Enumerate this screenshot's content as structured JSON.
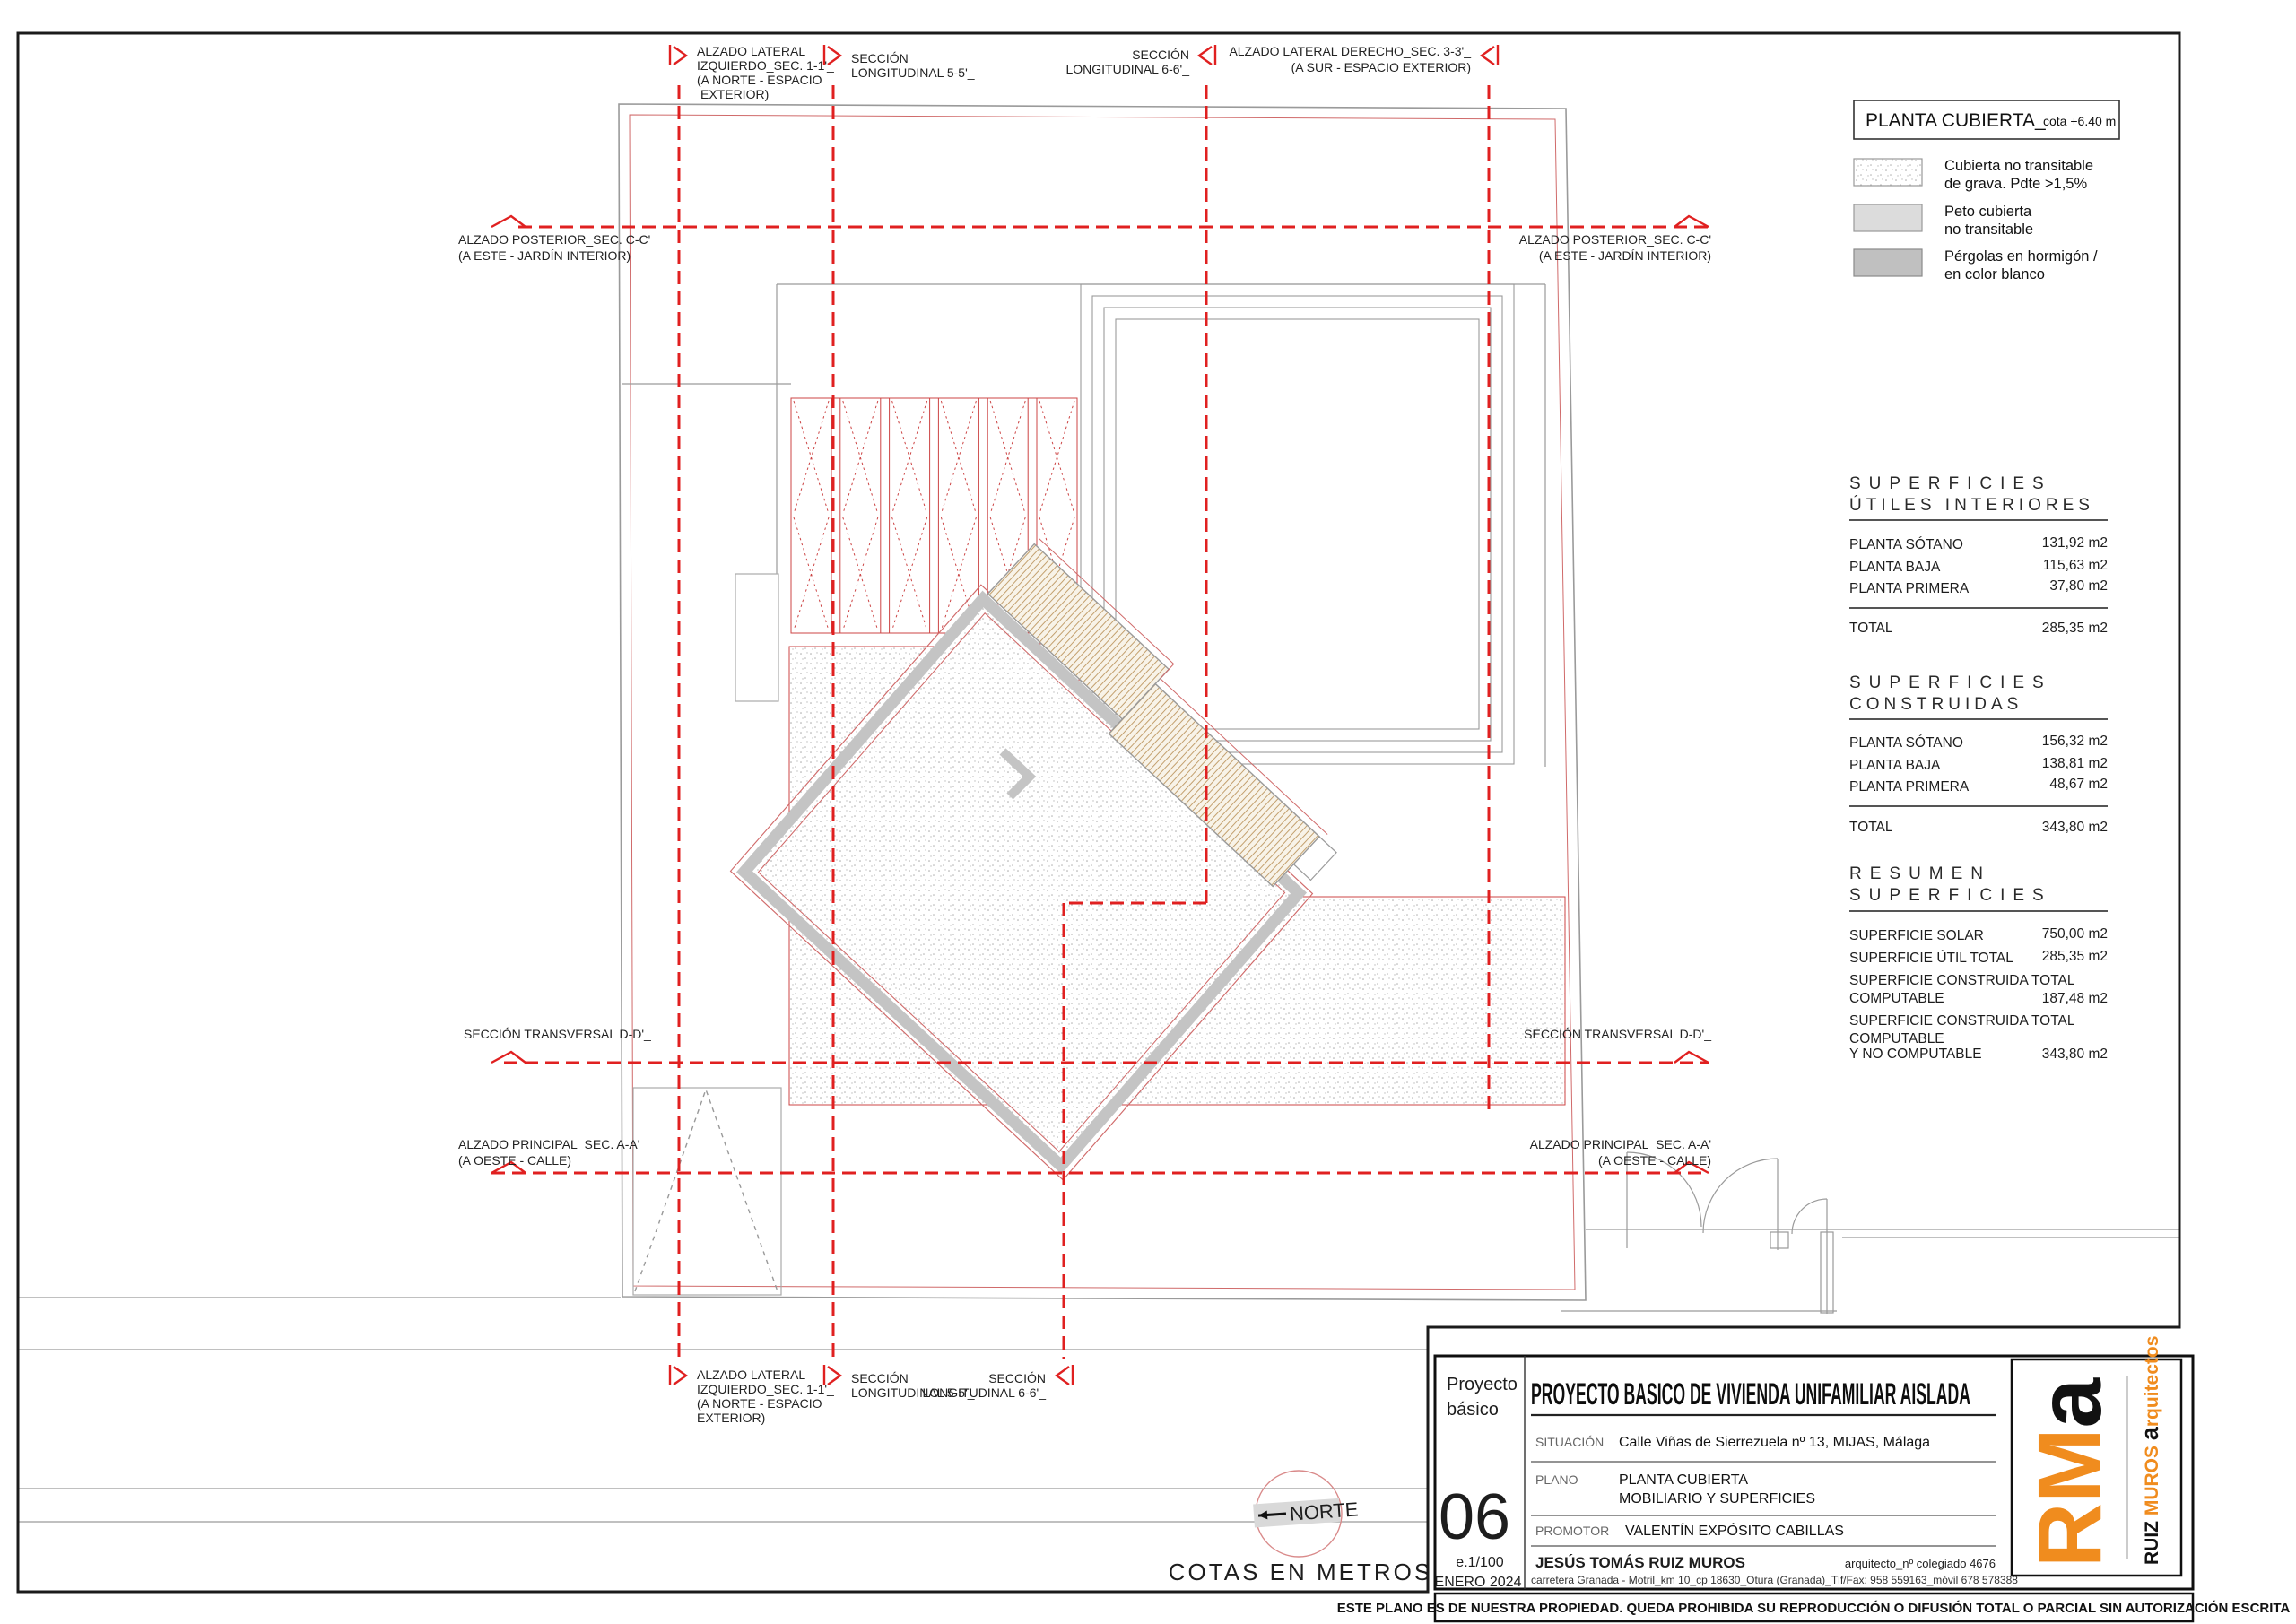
{
  "colors": {
    "section_red": "#e02020",
    "thin_red": "#cc4444",
    "wall_gray": "#c4c4c4",
    "structure_gray": "#9a9a9a",
    "brand_orange": "#f08c1e"
  },
  "legend": {
    "title": "PLANTA CUBIERTA_",
    "subtitle": "cota +6.40 m",
    "items": [
      {
        "lines": [
          "Cubierta no transitable",
          "de grava. Pdte >1,5%"
        ]
      },
      {
        "lines": [
          "Peto cubierta",
          "no transitable"
        ]
      },
      {
        "lines": [
          "Pérgolas en hormigón /",
          "en color blanco"
        ]
      }
    ]
  },
  "tables": {
    "utiles": {
      "title_line1": "SUPERFICIES",
      "title_line2": "ÚTILES INTERIORES",
      "rows": [
        {
          "label": "PLANTA SÓTANO",
          "value": "131,92 m2"
        },
        {
          "label": "PLANTA BAJA",
          "value": "115,63 m2"
        },
        {
          "label": "PLANTA PRIMERA",
          "value": "37,80 m2"
        }
      ],
      "total_label": "TOTAL",
      "total_value": "285,35 m2"
    },
    "construidas": {
      "title_line1": "SUPERFICIES",
      "title_line2": "CONSTRUIDAS",
      "rows": [
        {
          "label": "PLANTA SÓTANO",
          "value": "156,32 m2"
        },
        {
          "label": "PLANTA BAJA",
          "value": "138,81 m2"
        },
        {
          "label": "PLANTA PRIMERA",
          "value": "48,67 m2"
        }
      ],
      "total_label": "TOTAL",
      "total_value": "343,80 m2"
    },
    "resumen": {
      "title_line1": "RESUMEN",
      "title_line2": "SUPERFICIES",
      "rows": [
        {
          "lines": [
            "SUPERFICIE SOLAR"
          ],
          "value": "750,00 m2"
        },
        {
          "lines": [
            "SUPERFICIE ÚTIL TOTAL"
          ],
          "value": "285,35 m2"
        },
        {
          "lines": [
            "SUPERFICIE CONSTRUIDA TOTAL",
            "COMPUTABLE"
          ],
          "value": "187,48 m2"
        },
        {
          "lines": [
            "SUPERFICIE CONSTRUIDA TOTAL",
            "COMPUTABLE",
            "Y NO COMPUTABLE"
          ],
          "value": "343,80 m2"
        }
      ]
    }
  },
  "sections": {
    "lateral_izquierdo": {
      "lines": [
        "ALZADO LATERAL",
        "IZQUIERDO_SEC. 1-1'_",
        "(A NORTE - ESPACIO",
        "EXTERIOR)"
      ]
    },
    "long5": {
      "lines": [
        "SECCIÓN",
        "LONGITUDINAL 5-5'_"
      ]
    },
    "long6": {
      "lines": [
        "SECCIÓN",
        "LONGITUDINAL 6-6'_"
      ]
    },
    "lateral_derecho": {
      "lines": [
        "ALZADO LATERAL DERECHO_SEC. 3-3'_",
        "(A SUR - ESPACIO EXTERIOR)"
      ]
    },
    "posterior": {
      "lines": [
        "ALZADO POSTERIOR_SEC. C-C'",
        "(A ESTE - JARDÍN INTERIOR)"
      ]
    },
    "transversal": {
      "lines": [
        "SECCIÓN TRANSVERSAL D-D'_"
      ]
    },
    "principal": {
      "lines": [
        "ALZADO PRINCIPAL_SEC. A-A'",
        "(A OESTE - CALLE)"
      ]
    }
  },
  "compass": {
    "north_label": "NORTE"
  },
  "notes": {
    "cotas": "COTAS EN METROS"
  },
  "titleblock": {
    "project_type_line1": "Proyecto",
    "project_type_line2": "básico",
    "sheet_number": "06",
    "scale": "e.1/100",
    "date": "ENERO 2024",
    "title": "PROYECTO BASICO DE VIVIENDA UNIFAMILIAR AISLADA",
    "situacion_label": "SITUACIÓN",
    "situacion_value": "Calle Viñas de Sierrezuela nº 13, MIJAS, Málaga",
    "plano_label": "PLANO",
    "plano_line1": "PLANTA CUBIERTA",
    "plano_line2": "MOBILIARIO Y SUPERFICIES",
    "promotor_label": "PROMOTOR",
    "promotor_value": "VALENTÍN EXPÓSITO CABILLAS",
    "architect_name": "JESÚS TOMÁS RUIZ MUROS",
    "architect_number": "arquitecto_nº colegiado 4676",
    "architect_address": "carretera Granada - Motril_km 10_cp 18630_Otura (Granada)_Tlf/Fax: 958 559163_móvil 678 578388",
    "copyright": "ESTE PLANO ES DE NUESTRA PROPIEDAD. QUEDA PROHIBIDA SU REPRODUCCIÓN O DIFUSIÓN TOTAL O PARCIAL SIN AUTORIZACIÓN ESCRITA",
    "logo": {
      "rm": "RM",
      "a": "a",
      "brand_ruiz": "RUIZ ",
      "brand_muros": "MUROS ",
      "brand_a": "a",
      "brand_rest": "rquitectos"
    }
  }
}
